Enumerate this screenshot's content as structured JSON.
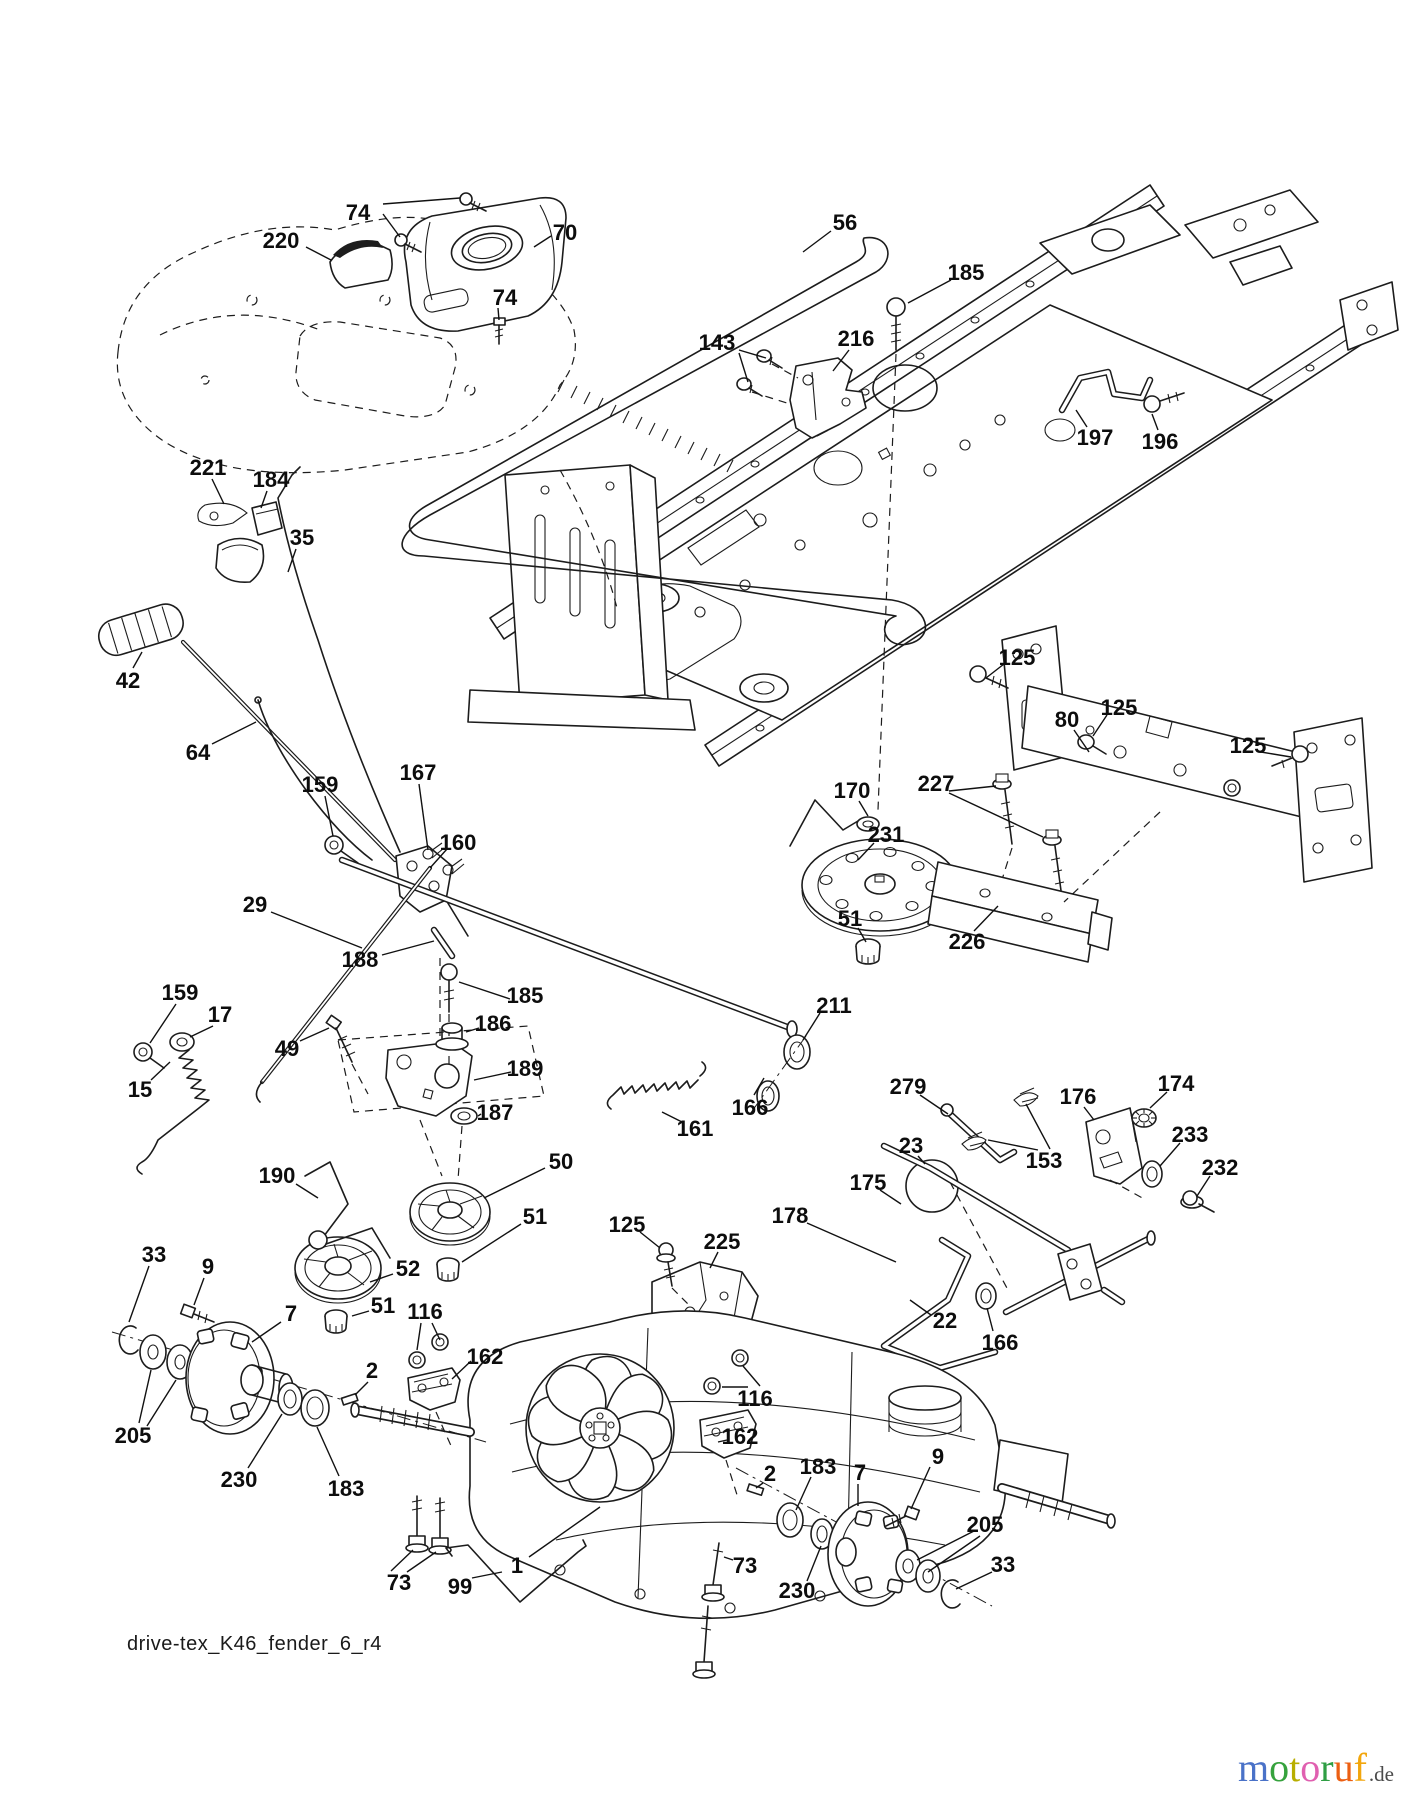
{
  "meta": {
    "width": 1401,
    "height": 1800,
    "type": "exploded-parts-diagram"
  },
  "footer": {
    "drawing_code": "drive-tex_K46_fender_6_r4"
  },
  "logo": {
    "letters": [
      {
        "ch": "m",
        "color": "#4a72c8"
      },
      {
        "ch": "o",
        "color": "#36a23d"
      },
      {
        "ch": "t",
        "color": "#b8ae00"
      },
      {
        "ch": "o",
        "color": "#e060b0"
      },
      {
        "ch": "r",
        "color": "#2f9e44"
      },
      {
        "ch": "u",
        "color": "#ec5f12"
      },
      {
        "ch": "f",
        "color": "#f2a60d"
      }
    ],
    "suffix": ".de"
  },
  "labels": [
    {
      "t": "74",
      "x": 358,
      "y": 212,
      "l": [
        [
          383,
          204,
          460,
          198
        ],
        [
          383,
          214,
          400,
          237
        ]
      ]
    },
    {
      "t": "220",
      "x": 281,
      "y": 240,
      "l": [
        [
          306,
          247,
          331,
          260
        ]
      ]
    },
    {
      "t": "70",
      "x": 565,
      "y": 232,
      "l": [
        [
          551,
          236,
          534,
          247
        ]
      ]
    },
    {
      "t": "74",
      "x": 505,
      "y": 297,
      "l": [
        [
          498,
          308,
          499,
          320
        ]
      ]
    },
    {
      "t": "56",
      "x": 845,
      "y": 222,
      "l": [
        [
          831,
          231,
          803,
          252
        ]
      ]
    },
    {
      "t": "185",
      "x": 966,
      "y": 272,
      "l": [
        [
          951,
          280,
          908,
          303
        ]
      ]
    },
    {
      "t": "143",
      "x": 717,
      "y": 342,
      "l": [
        [
          739,
          350,
          766,
          358
        ],
        [
          739,
          353,
          748,
          382
        ]
      ]
    },
    {
      "t": "216",
      "x": 856,
      "y": 338,
      "l": [
        [
          849,
          350,
          833,
          371
        ]
      ]
    },
    {
      "t": "197",
      "x": 1095,
      "y": 437,
      "l": [
        [
          1087,
          427,
          1076,
          410
        ]
      ]
    },
    {
      "t": "196",
      "x": 1160,
      "y": 441,
      "l": [
        [
          1158,
          430,
          1152,
          414
        ]
      ]
    },
    {
      "t": "221",
      "x": 208,
      "y": 467,
      "l": [
        [
          212,
          479,
          224,
          504
        ]
      ]
    },
    {
      "t": "184",
      "x": 271,
      "y": 479,
      "l": [
        [
          267,
          491,
          261,
          508
        ]
      ]
    },
    {
      "t": "35",
      "x": 302,
      "y": 537,
      "l": [
        [
          296,
          549,
          288,
          572
        ]
      ]
    },
    {
      "t": "42",
      "x": 128,
      "y": 680,
      "l": [
        [
          133,
          668,
          142,
          652
        ]
      ]
    },
    {
      "t": "64",
      "x": 198,
      "y": 752,
      "l": [
        [
          212,
          744,
          256,
          722
        ]
      ]
    },
    {
      "t": "159",
      "x": 320,
      "y": 784,
      "l": [
        [
          325,
          796,
          333,
          836
        ]
      ]
    },
    {
      "t": "167",
      "x": 418,
      "y": 772,
      "l": [
        [
          419,
          784,
          428,
          850
        ]
      ]
    },
    {
      "t": "160",
      "x": 458,
      "y": 842,
      "l": [
        [
          447,
          849,
          430,
          868
        ]
      ]
    },
    {
      "t": "29",
      "x": 255,
      "y": 904,
      "l": [
        [
          271,
          912,
          362,
          948
        ]
      ]
    },
    {
      "t": "188",
      "x": 360,
      "y": 959,
      "l": [
        [
          382,
          955,
          434,
          941
        ]
      ]
    },
    {
      "t": "185",
      "x": 525,
      "y": 995,
      "l": [
        [
          510,
          999,
          459,
          982
        ]
      ]
    },
    {
      "t": "186",
      "x": 493,
      "y": 1023,
      "l": [
        [
          479,
          1028,
          466,
          1032
        ]
      ]
    },
    {
      "t": "189",
      "x": 525,
      "y": 1068,
      "l": [
        [
          511,
          1072,
          474,
          1080
        ]
      ]
    },
    {
      "t": "187",
      "x": 495,
      "y": 1112,
      "l": [
        [
          481,
          1114,
          478,
          1116
        ]
      ]
    },
    {
      "t": "49",
      "x": 287,
      "y": 1048,
      "l": [
        [
          300,
          1041,
          329,
          1028
        ]
      ]
    },
    {
      "t": "159",
      "x": 180,
      "y": 992,
      "l": [
        [
          176,
          1004,
          150,
          1043
        ]
      ]
    },
    {
      "t": "17",
      "x": 220,
      "y": 1014,
      "l": [
        [
          213,
          1026,
          190,
          1037
        ]
      ]
    },
    {
      "t": "15",
      "x": 140,
      "y": 1089,
      "l": [
        [
          151,
          1080,
          170,
          1062
        ]
      ]
    },
    {
      "t": "161",
      "x": 695,
      "y": 1128,
      "l": [
        [
          682,
          1122,
          662,
          1112
        ]
      ]
    },
    {
      "t": "211",
      "x": 834,
      "y": 1005,
      "l": [
        [
          820,
          1013,
          803,
          1040
        ]
      ]
    },
    {
      "t": "166",
      "x": 750,
      "y": 1107,
      "l": [
        [
          754,
          1095,
          764,
          1078
        ]
      ]
    },
    {
      "t": "50",
      "x": 561,
      "y": 1161,
      "l": [
        [
          545,
          1168,
          484,
          1198
        ]
      ]
    },
    {
      "t": "51",
      "x": 535,
      "y": 1216,
      "l": [
        [
          521,
          1224,
          462,
          1262
        ]
      ]
    },
    {
      "t": "190",
      "x": 277,
      "y": 1175,
      "l": [
        [
          296,
          1184,
          318,
          1198
        ]
      ]
    },
    {
      "t": "52",
      "x": 408,
      "y": 1268,
      "l": [
        [
          393,
          1274,
          370,
          1282
        ]
      ]
    },
    {
      "t": "51",
      "x": 383,
      "y": 1305,
      "l": [
        [
          369,
          1311,
          352,
          1316
        ]
      ]
    },
    {
      "t": "116",
      "x": 425,
      "y": 1311,
      "l": [
        [
          421,
          1323,
          417,
          1350
        ],
        [
          432,
          1323,
          440,
          1340
        ]
      ]
    },
    {
      "t": "162",
      "x": 485,
      "y": 1356,
      "l": [
        [
          471,
          1361,
          452,
          1379
        ]
      ]
    },
    {
      "t": "2",
      "x": 372,
      "y": 1370,
      "l": [
        [
          368,
          1382,
          355,
          1395
        ]
      ]
    },
    {
      "t": "33",
      "x": 154,
      "y": 1254,
      "l": [
        [
          149,
          1266,
          129,
          1322
        ]
      ]
    },
    {
      "t": "9",
      "x": 208,
      "y": 1266,
      "l": [
        [
          204,
          1278,
          194,
          1305
        ]
      ]
    },
    {
      "t": "7",
      "x": 291,
      "y": 1313,
      "l": [
        [
          281,
          1322,
          252,
          1342
        ]
      ]
    },
    {
      "t": "205",
      "x": 133,
      "y": 1435,
      "l": [
        [
          139,
          1423,
          151,
          1370
        ],
        [
          147,
          1426,
          176,
          1380
        ]
      ]
    },
    {
      "t": "230",
      "x": 239,
      "y": 1479,
      "l": [
        [
          248,
          1468,
          282,
          1414
        ]
      ]
    },
    {
      "t": "183",
      "x": 346,
      "y": 1488,
      "l": [
        [
          339,
          1476,
          317,
          1427
        ]
      ]
    },
    {
      "t": "73",
      "x": 399,
      "y": 1582,
      "l": [
        [
          391,
          1571,
          413,
          1550
        ],
        [
          407,
          1572,
          436,
          1552
        ]
      ]
    },
    {
      "t": "99",
      "x": 460,
      "y": 1586,
      "l": [
        [
          472,
          1578,
          502,
          1572
        ]
      ]
    },
    {
      "t": "1",
      "x": 517,
      "y": 1565,
      "l": [
        [
          529,
          1557,
          600,
          1507
        ]
      ]
    },
    {
      "t": "125",
      "x": 1017,
      "y": 657,
      "l": [
        [
          1004,
          664,
          986,
          678
        ]
      ]
    },
    {
      "t": "80",
      "x": 1067,
      "y": 719,
      "l": [
        [
          1074,
          730,
          1089,
          752
        ]
      ]
    },
    {
      "t": "125",
      "x": 1119,
      "y": 707,
      "l": [
        [
          1107,
          715,
          1093,
          736
        ]
      ]
    },
    {
      "t": "125",
      "x": 1248,
      "y": 745,
      "l": [
        [
          1261,
          752,
          1291,
          757
        ]
      ]
    },
    {
      "t": "227",
      "x": 936,
      "y": 783,
      "l": [
        [
          949,
          791,
          996,
          786
        ],
        [
          949,
          793,
          1043,
          837
        ]
      ]
    },
    {
      "t": "170",
      "x": 852,
      "y": 790,
      "l": [
        [
          859,
          801,
          868,
          816
        ]
      ]
    },
    {
      "t": "231",
      "x": 886,
      "y": 834,
      "l": [
        [
          874,
          843,
          858,
          860
        ]
      ]
    },
    {
      "t": "51",
      "x": 850,
      "y": 918,
      "l": [
        [
          858,
          928,
          866,
          942
        ]
      ]
    },
    {
      "t": "226",
      "x": 967,
      "y": 941,
      "l": [
        [
          974,
          931,
          998,
          906
        ]
      ]
    },
    {
      "t": "279",
      "x": 908,
      "y": 1086,
      "l": [
        [
          920,
          1095,
          948,
          1114
        ]
      ]
    },
    {
      "t": "174",
      "x": 1176,
      "y": 1083,
      "l": [
        [
          1167,
          1092,
          1150,
          1108
        ]
      ]
    },
    {
      "t": "176",
      "x": 1078,
      "y": 1096,
      "l": [
        [
          1084,
          1107,
          1094,
          1120
        ]
      ]
    },
    {
      "t": "23",
      "x": 911,
      "y": 1145,
      "l": [
        [
          918,
          1156,
          925,
          1164
        ]
      ]
    },
    {
      "t": "153",
      "x": 1044,
      "y": 1160,
      "l": [
        [
          1050,
          1149,
          1026,
          1104
        ],
        [
          1038,
          1150,
          988,
          1140
        ]
      ]
    },
    {
      "t": "233",
      "x": 1190,
      "y": 1134,
      "l": [
        [
          1180,
          1143,
          1160,
          1166
        ]
      ]
    },
    {
      "t": "232",
      "x": 1220,
      "y": 1167,
      "l": [
        [
          1210,
          1176,
          1197,
          1196
        ]
      ]
    },
    {
      "t": "175",
      "x": 868,
      "y": 1182,
      "l": [
        [
          880,
          1190,
          901,
          1204
        ]
      ]
    },
    {
      "t": "178",
      "x": 790,
      "y": 1215,
      "l": [
        [
          807,
          1223,
          896,
          1262
        ]
      ]
    },
    {
      "t": "225",
      "x": 722,
      "y": 1241,
      "l": [
        [
          718,
          1252,
          710,
          1268
        ]
      ]
    },
    {
      "t": "125",
      "x": 627,
      "y": 1224,
      "l": [
        [
          640,
          1232,
          660,
          1248
        ]
      ]
    },
    {
      "t": "22",
      "x": 945,
      "y": 1320,
      "l": [
        [
          931,
          1315,
          910,
          1300
        ]
      ]
    },
    {
      "t": "166",
      "x": 1000,
      "y": 1342,
      "l": [
        [
          993,
          1331,
          987,
          1308
        ]
      ]
    },
    {
      "t": "116",
      "x": 755,
      "y": 1398,
      "l": [
        [
          748,
          1387,
          722,
          1387
        ],
        [
          760,
          1386,
          743,
          1366
        ]
      ]
    },
    {
      "t": "162",
      "x": 740,
      "y": 1436,
      "l": [
        [
          727,
          1440,
          718,
          1442
        ]
      ]
    },
    {
      "t": "2",
      "x": 770,
      "y": 1473,
      "l": [
        [
          763,
          1483,
          756,
          1488
        ]
      ]
    },
    {
      "t": "183",
      "x": 818,
      "y": 1466,
      "l": [
        [
          811,
          1477,
          796,
          1510
        ]
      ]
    },
    {
      "t": "7",
      "x": 860,
      "y": 1472,
      "l": [
        [
          858,
          1484,
          858,
          1506
        ]
      ]
    },
    {
      "t": "9",
      "x": 938,
      "y": 1456,
      "l": [
        [
          930,
          1467,
          911,
          1509
        ]
      ]
    },
    {
      "t": "205",
      "x": 985,
      "y": 1524,
      "l": [
        [
          974,
          1531,
          917,
          1560
        ],
        [
          980,
          1536,
          928,
          1572
        ]
      ]
    },
    {
      "t": "33",
      "x": 1003,
      "y": 1564,
      "l": [
        [
          992,
          1572,
          956,
          1589
        ]
      ]
    },
    {
      "t": "230",
      "x": 797,
      "y": 1590,
      "l": [
        [
          807,
          1581,
          821,
          1546
        ]
      ]
    },
    {
      "t": "73",
      "x": 745,
      "y": 1565,
      "l": [
        [
          733,
          1560,
          724,
          1557
        ]
      ]
    }
  ]
}
